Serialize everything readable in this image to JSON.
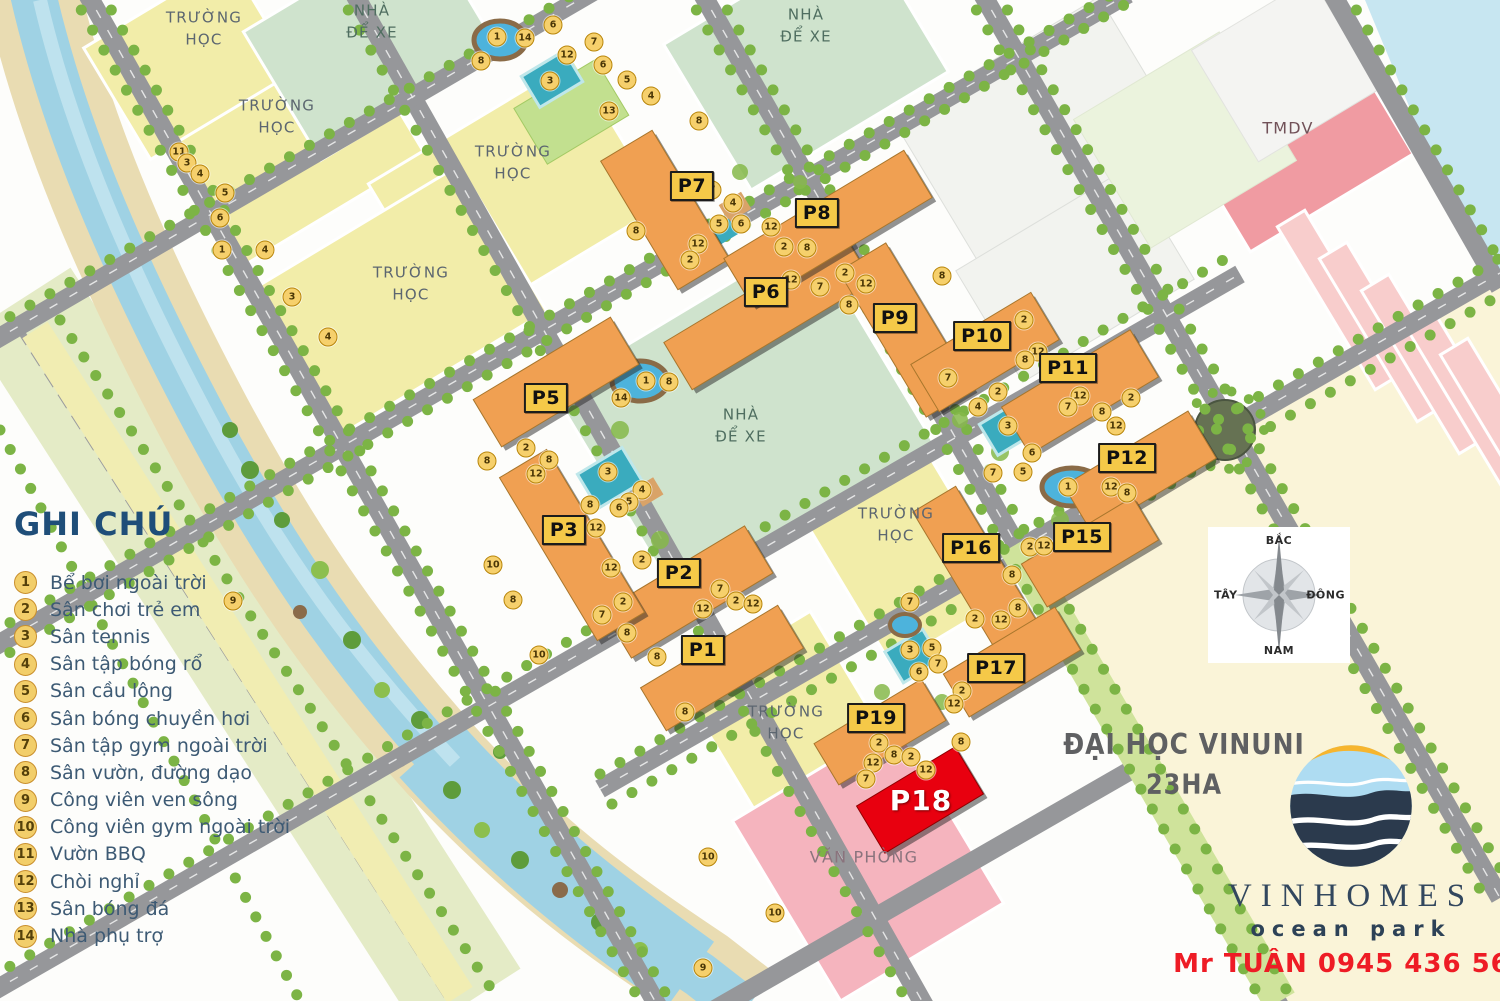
{
  "legend": {
    "title": "GHI CHÚ",
    "items": [
      {
        "n": 1,
        "label": "Bể bơi ngoài trời"
      },
      {
        "n": 2,
        "label": "Sân chơi trẻ em"
      },
      {
        "n": 3,
        "label": "Sân tennis"
      },
      {
        "n": 4,
        "label": "Sân tập bóng rổ"
      },
      {
        "n": 5,
        "label": "Sân cầu lông"
      },
      {
        "n": 6,
        "label": "Sân bóng chuyền hơi"
      },
      {
        "n": 7,
        "label": "Sân tập gym ngoài trời"
      },
      {
        "n": 8,
        "label": "Sân vườn, đường dạo"
      },
      {
        "n": 9,
        "label": "Công viên ven sông"
      },
      {
        "n": 10,
        "label": "Công viên gym ngoài trời"
      },
      {
        "n": 11,
        "label": "Vườn BBQ"
      },
      {
        "n": 12,
        "label": "Chòi nghỉ"
      },
      {
        "n": 13,
        "label": "Sân bóng đá"
      },
      {
        "n": 14,
        "label": "Nhà phụ trợ"
      }
    ]
  },
  "compass": {
    "north": "BẮC",
    "south": "NAM",
    "east": "ĐÔNG",
    "west": "TÂY"
  },
  "university": {
    "line1": "ĐẠI HỌC VINUNI",
    "line2": "23HA"
  },
  "branding": {
    "name": "VINHOMES",
    "sub": "ocean park",
    "contact": "Mr TUÂN 0945 436 569"
  },
  "buildings": [
    {
      "id": "P1",
      "lx": 703,
      "ly": 650,
      "cx": 722,
      "cy": 668,
      "w": 160,
      "h": 50
    },
    {
      "id": "P2",
      "lx": 679,
      "ly": 573,
      "cx": 688,
      "cy": 592,
      "w": 165,
      "h": 55
    },
    {
      "id": "P3",
      "lx": 564,
      "ly": 530,
      "cx": 572,
      "cy": 545,
      "w": 55,
      "h": 190
    },
    {
      "id": "P5",
      "lx": 546,
      "ly": 398,
      "cx": 556,
      "cy": 382,
      "w": 160,
      "h": 55
    },
    {
      "id": "P6",
      "lx": 766,
      "ly": 292,
      "cx": 768,
      "cy": 312,
      "w": 210,
      "h": 55
    },
    {
      "id": "P7",
      "lx": 692,
      "ly": 186,
      "cx": 665,
      "cy": 210,
      "w": 60,
      "h": 150
    },
    {
      "id": "P8",
      "lx": 817,
      "ly": 213,
      "cx": 828,
      "cy": 228,
      "w": 210,
      "h": 55
    },
    {
      "id": "P9",
      "lx": 895,
      "ly": 318,
      "cx": 906,
      "cy": 330,
      "w": 55,
      "h": 170
    },
    {
      "id": "P10",
      "lx": 982,
      "ly": 336,
      "cx": 985,
      "cy": 352,
      "w": 140,
      "h": 55
    },
    {
      "id": "P11",
      "lx": 1068,
      "ly": 368,
      "cx": 1080,
      "cy": 392,
      "w": 150,
      "h": 55
    },
    {
      "id": "P12",
      "lx": 1127,
      "ly": 458,
      "cx": 1140,
      "cy": 472,
      "w": 145,
      "h": 55
    },
    {
      "id": "P15",
      "lx": 1082,
      "ly": 537,
      "cx": 1090,
      "cy": 552,
      "w": 130,
      "h": 50
    },
    {
      "id": "P16",
      "lx": 971,
      "ly": 548,
      "cx": 978,
      "cy": 572,
      "w": 50,
      "h": 170
    },
    {
      "id": "P17",
      "lx": 996,
      "ly": 668,
      "cx": 1012,
      "cy": 662,
      "w": 130,
      "h": 50
    },
    {
      "id": "P19",
      "lx": 876,
      "ly": 718,
      "cx": 880,
      "cy": 732,
      "w": 125,
      "h": 48
    },
    {
      "id": "P18",
      "lx": 921,
      "ly": 801,
      "cx": 920,
      "cy": 800,
      "w": 115,
      "h": 55,
      "highlight": true
    }
  ],
  "area_labels": [
    {
      "text": "TRƯỜNG\nHỌC",
      "x": 204,
      "y": 29,
      "type": "school"
    },
    {
      "text": "TRƯỜNG\nHỌC",
      "x": 277,
      "y": 117,
      "type": "school"
    },
    {
      "text": "TRƯỜNG\nHỌC",
      "x": 513,
      "y": 163,
      "type": "school"
    },
    {
      "text": "TRƯỜNG\nHỌC",
      "x": 411,
      "y": 284,
      "type": "school"
    },
    {
      "text": "TRƯỜNG\nHỌC",
      "x": 896,
      "y": 525,
      "type": "school"
    },
    {
      "text": "TRƯỜNG\nHỌC",
      "x": 786,
      "y": 723,
      "type": "school"
    },
    {
      "text": "NHÀ\nĐỂ XE",
      "x": 372,
      "y": 22,
      "type": "parking"
    },
    {
      "text": "NHÀ\nĐỂ XE",
      "x": 806,
      "y": 26,
      "type": "parking"
    },
    {
      "text": "NHÀ\nĐỂ XE",
      "x": 741,
      "y": 426,
      "type": "parking"
    },
    {
      "text": "TMDV",
      "x": 1288,
      "y": 128,
      "type": "tmdv"
    },
    {
      "text": "VĂN PHÒNG",
      "x": 864,
      "y": 857,
      "type": "office"
    }
  ],
  "markers": [
    [
      6,
      553,
      25
    ],
    [
      1,
      497,
      37
    ],
    [
      14,
      525,
      38
    ],
    [
      7,
      594,
      42
    ],
    [
      12,
      567,
      55
    ],
    [
      8,
      481,
      61
    ],
    [
      6,
      603,
      65
    ],
    [
      5,
      627,
      80
    ],
    [
      3,
      550,
      81
    ],
    [
      4,
      651,
      96
    ],
    [
      13,
      609,
      111
    ],
    [
      8,
      699,
      121
    ],
    [
      11,
      179,
      152
    ],
    [
      3,
      187,
      163
    ],
    [
      4,
      200,
      174
    ],
    [
      5,
      225,
      193
    ],
    [
      6,
      220,
      218
    ],
    [
      1,
      222,
      250
    ],
    [
      4,
      265,
      250
    ],
    [
      3,
      292,
      297
    ],
    [
      4,
      328,
      337
    ],
    [
      7,
      712,
      190
    ],
    [
      4,
      733,
      203
    ],
    [
      5,
      719,
      224
    ],
    [
      6,
      741,
      224
    ],
    [
      12,
      771,
      227
    ],
    [
      2,
      784,
      247
    ],
    [
      8,
      807,
      248
    ],
    [
      12,
      698,
      244
    ],
    [
      2,
      690,
      260
    ],
    [
      8,
      636,
      231
    ],
    [
      12,
      791,
      280
    ],
    [
      7,
      820,
      287
    ],
    [
      2,
      845,
      273
    ],
    [
      12,
      866,
      284
    ],
    [
      8,
      849,
      305
    ],
    [
      8,
      942,
      276
    ],
    [
      2,
      1024,
      320
    ],
    [
      12,
      1038,
      352
    ],
    [
      8,
      1025,
      360
    ],
    [
      7,
      948,
      378
    ],
    [
      2,
      998,
      392
    ],
    [
      4,
      978,
      407
    ],
    [
      3,
      1008,
      426
    ],
    [
      12,
      1080,
      396
    ],
    [
      7,
      1068,
      407
    ],
    [
      2,
      1131,
      398
    ],
    [
      8,
      1102,
      412
    ],
    [
      12,
      1116,
      426
    ],
    [
      6,
      1032,
      453
    ],
    [
      5,
      1023,
      472
    ],
    [
      7,
      993,
      473
    ],
    [
      1,
      1068,
      487
    ],
    [
      12,
      1111,
      487
    ],
    [
      8,
      1127,
      493
    ],
    [
      1,
      646,
      381
    ],
    [
      8,
      669,
      382
    ],
    [
      14,
      621,
      398
    ],
    [
      8,
      487,
      461
    ],
    [
      2,
      526,
      448
    ],
    [
      8,
      549,
      460
    ],
    [
      12,
      536,
      474
    ],
    [
      3,
      608,
      472
    ],
    [
      4,
      642,
      490
    ],
    [
      5,
      629,
      502
    ],
    [
      6,
      619,
      508
    ],
    [
      8,
      590,
      505
    ],
    [
      12,
      596,
      528
    ],
    [
      10,
      493,
      565
    ],
    [
      2,
      642,
      560
    ],
    [
      12,
      611,
      568
    ],
    [
      2,
      623,
      602
    ],
    [
      8,
      513,
      600
    ],
    [
      7,
      602,
      615
    ],
    [
      8,
      627,
      633
    ],
    [
      10,
      539,
      655
    ],
    [
      8,
      657,
      657
    ],
    [
      12,
      703,
      609
    ],
    [
      7,
      720,
      589
    ],
    [
      2,
      736,
      601
    ],
    [
      12,
      753,
      604
    ],
    [
      8,
      685,
      712
    ],
    [
      9,
      233,
      601
    ],
    [
      2,
      1030,
      547
    ],
    [
      12,
      1044,
      546
    ],
    [
      8,
      1012,
      575
    ],
    [
      8,
      1018,
      608
    ],
    [
      2,
      975,
      619
    ],
    [
      12,
      1001,
      620
    ],
    [
      7,
      910,
      602
    ],
    [
      3,
      910,
      650
    ],
    [
      5,
      932,
      648
    ],
    [
      6,
      919,
      672
    ],
    [
      7,
      938,
      664
    ],
    [
      2,
      962,
      691
    ],
    [
      12,
      954,
      704
    ],
    [
      8,
      961,
      742
    ],
    [
      2,
      879,
      743
    ],
    [
      8,
      894,
      755
    ],
    [
      2,
      911,
      757
    ],
    [
      12,
      926,
      770
    ],
    [
      12,
      873,
      763
    ],
    [
      7,
      866,
      779
    ],
    [
      10,
      708,
      857
    ],
    [
      10,
      775,
      913
    ],
    [
      9,
      703,
      968
    ]
  ],
  "colors": {
    "building_orange": "#f0a052",
    "highlight_red": "#e8000f",
    "label_yellow": "#f5c948",
    "school_yellow": "#f2eda9",
    "parking_green": "#cfe3cd",
    "commercial_pink": "#f09ba2",
    "office_pink": "#f5b4be",
    "road_gray": "#96979a",
    "river_blue": "#9fd2e4",
    "tree_green": "#7cb445",
    "legend_navy": "#1f4e79",
    "phone_red": "#ee1c25"
  }
}
